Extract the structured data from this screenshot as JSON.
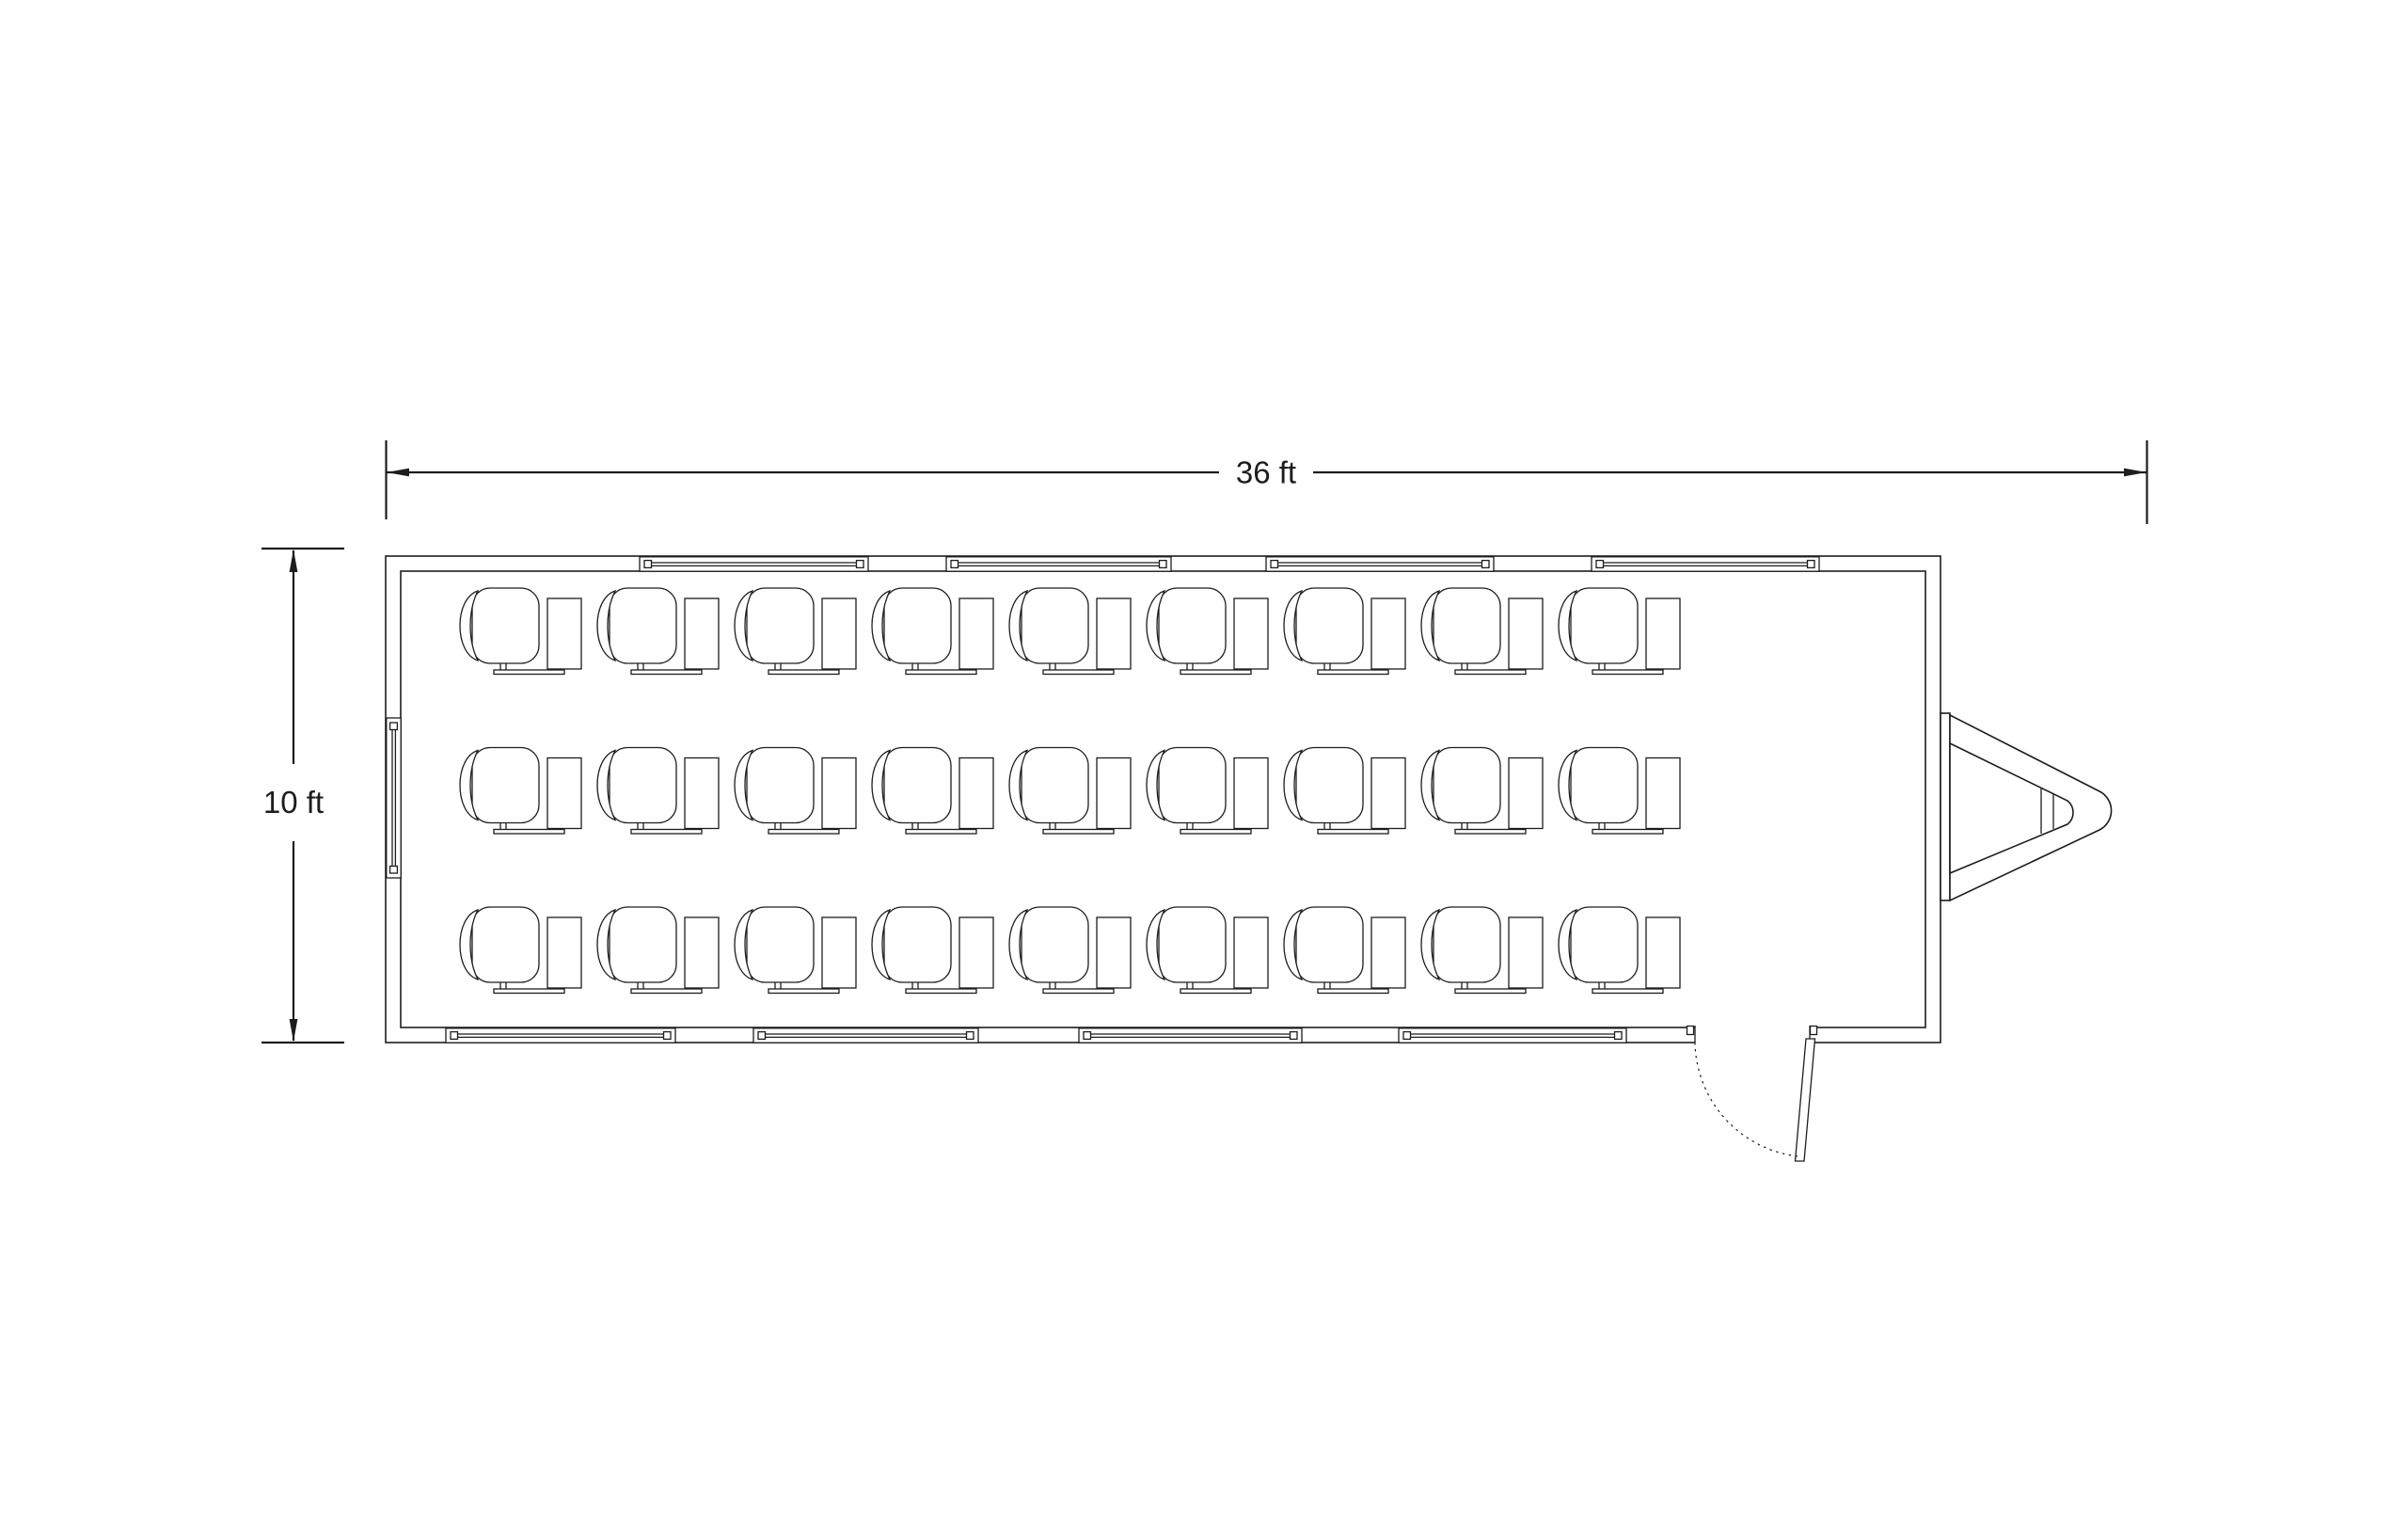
{
  "canvas": {
    "background": "#ffffff",
    "line_color": "#1d1d1d"
  },
  "dimensions": {
    "width": {
      "label": "36 ft"
    },
    "height": {
      "label": "10 ft"
    }
  },
  "floor_plan": {
    "desks": {
      "rows": 3,
      "columns": 9,
      "total": 27
    },
    "windows": {
      "top_wall": 4,
      "bottom_wall": 4,
      "left_wall": 1
    },
    "door": {
      "count": 1,
      "position": "bottom-right",
      "swing": "outward"
    },
    "hitch": {
      "position": "right-end"
    }
  }
}
